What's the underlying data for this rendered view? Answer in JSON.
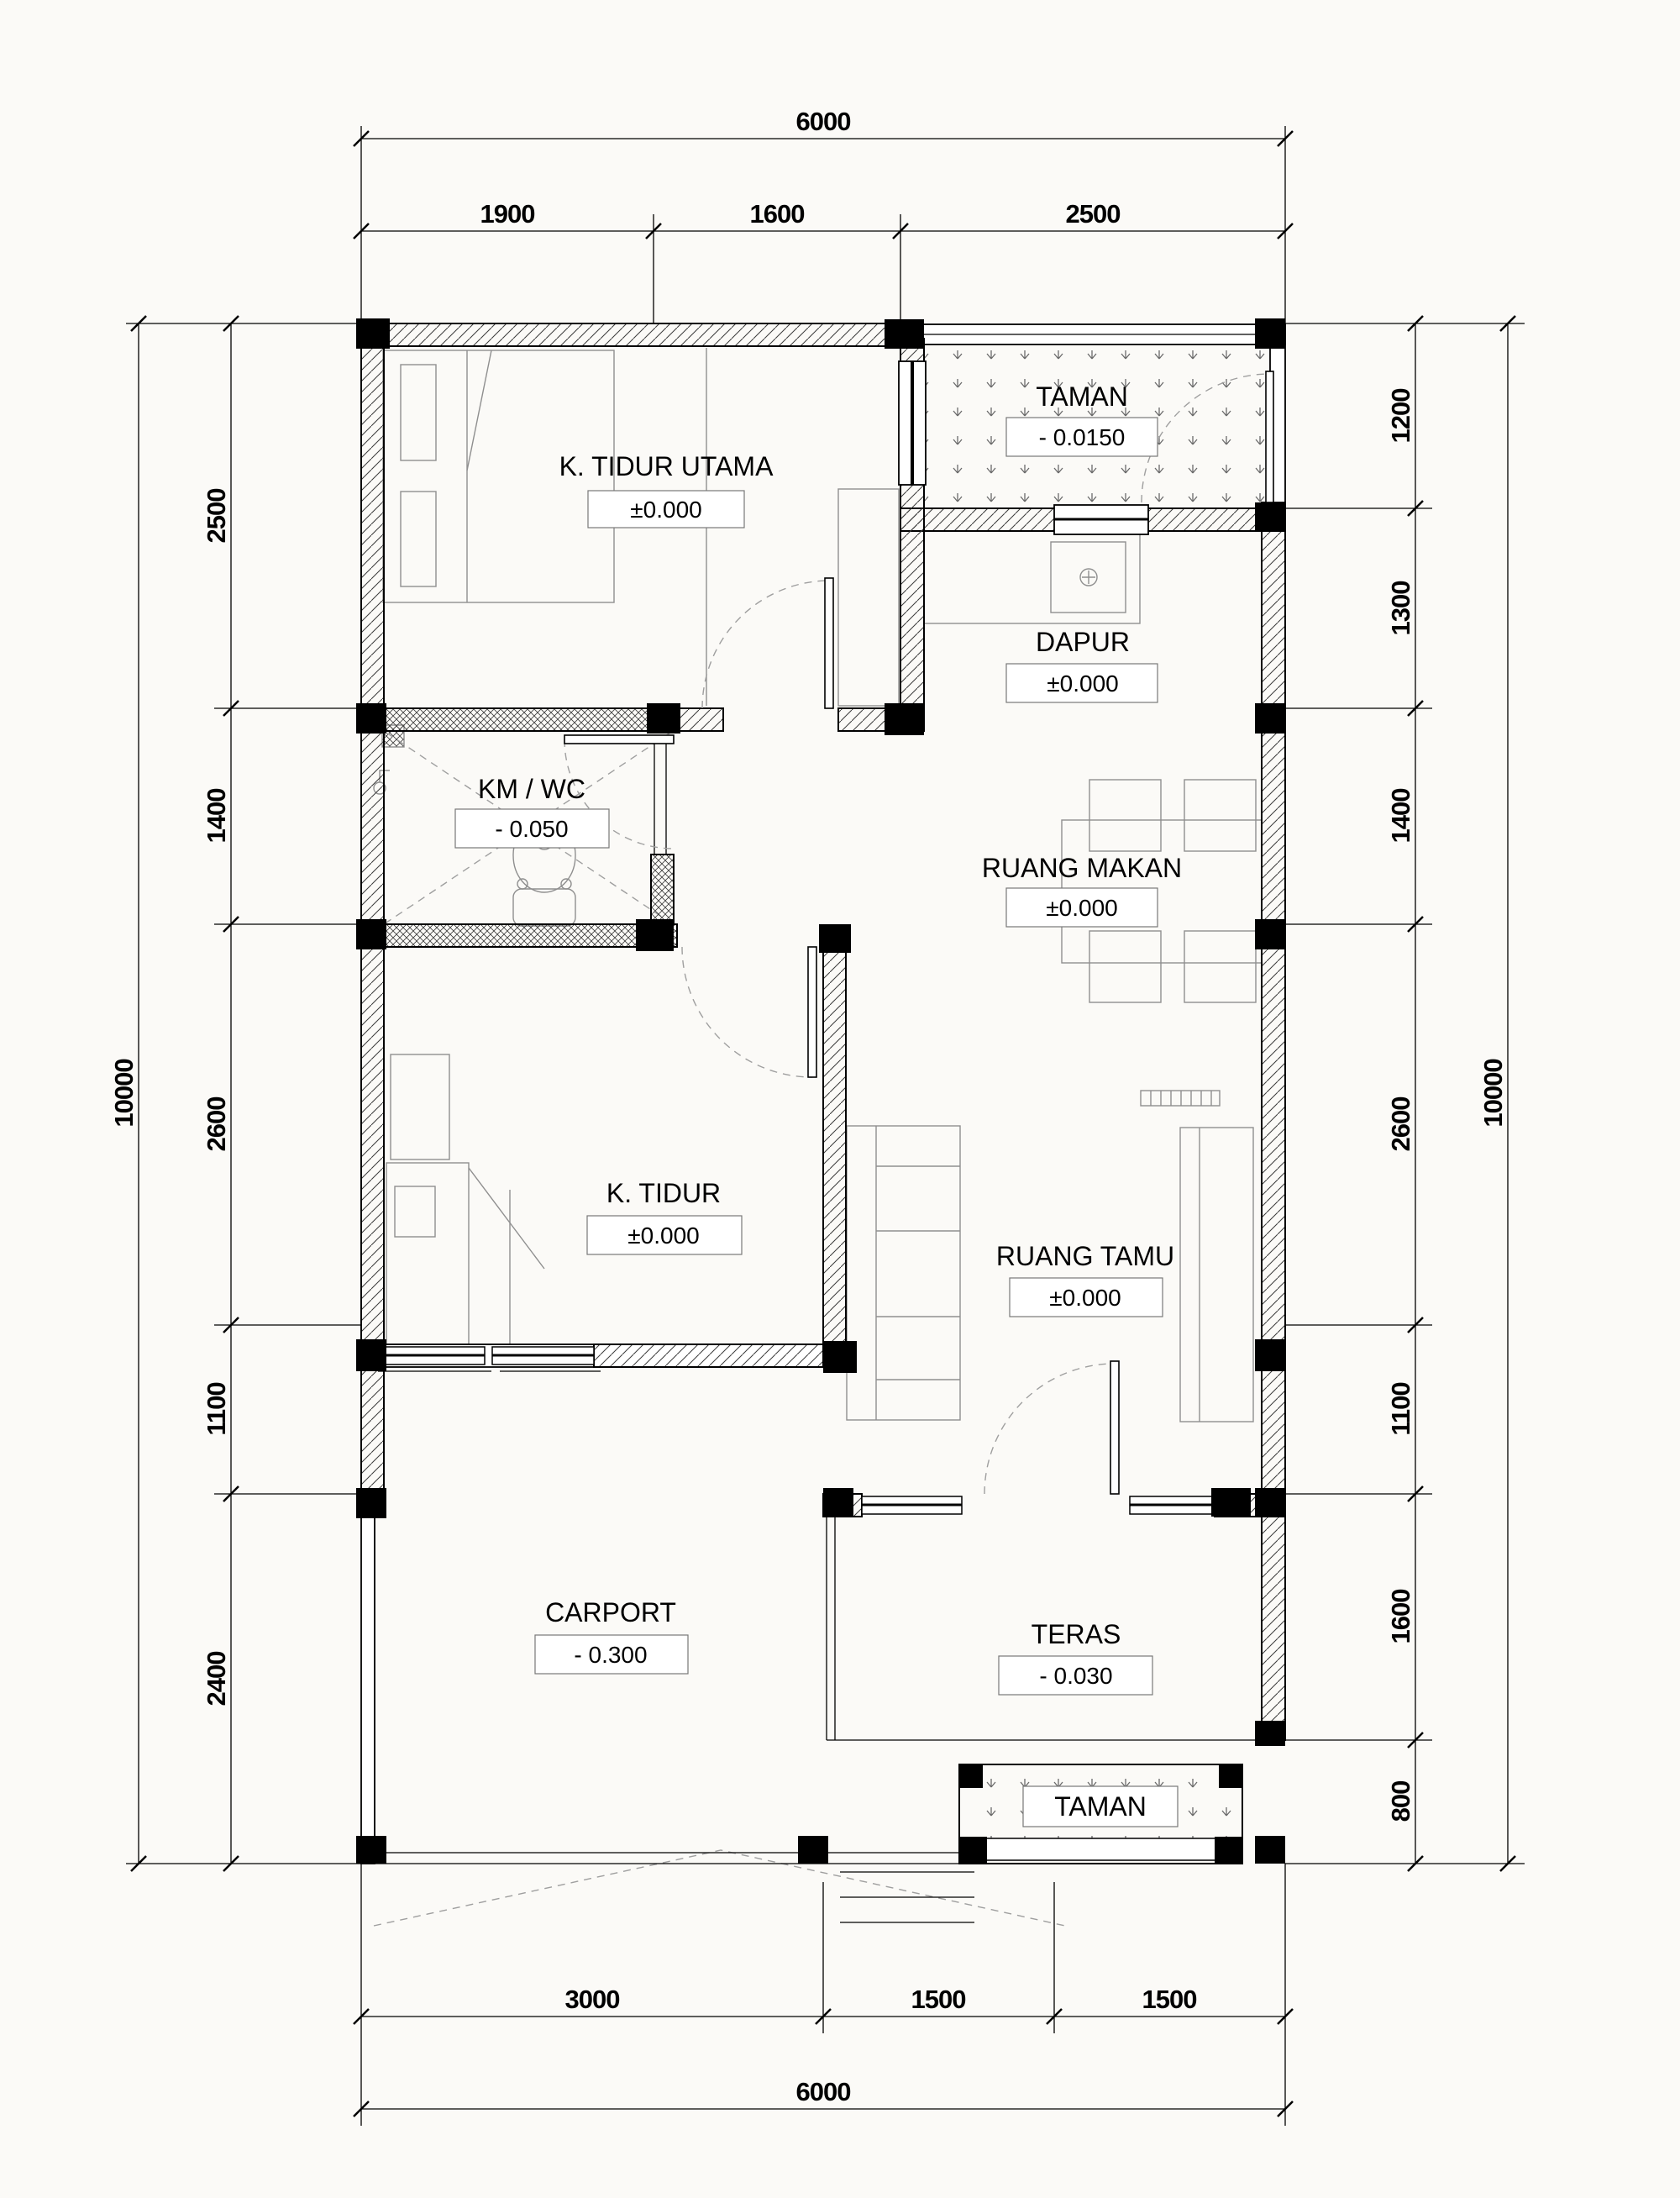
{
  "rooms": {
    "k_tidur_utama": {
      "name": "K. TIDUR UTAMA",
      "level": "±0.000"
    },
    "taman_top": {
      "name": "TAMAN",
      "level": "- 0.0150"
    },
    "dapur": {
      "name": "DAPUR",
      "level": "±0.000"
    },
    "km_wc": {
      "name": "KM / WC",
      "level": "- 0.050"
    },
    "ruang_makan": {
      "name": "RUANG MAKAN",
      "level": "±0.000"
    },
    "k_tidur": {
      "name": "K. TIDUR",
      "level": "±0.000"
    },
    "ruang_tamu": {
      "name": "RUANG TAMU",
      "level": "±0.000"
    },
    "carport": {
      "name": "CARPORT",
      "level": "- 0.300"
    },
    "teras": {
      "name": "TERAS",
      "level": "- 0.030"
    },
    "taman_bottom": {
      "name": "TAMAN"
    }
  },
  "dimensions": {
    "top_total": "6000",
    "top_segments": [
      "1900",
      "1600",
      "2500"
    ],
    "left_total": "10000",
    "left_segments": [
      "2500",
      "1400",
      "2600",
      "1100",
      "2400"
    ],
    "right_total": "10000",
    "right_segments": [
      "1200",
      "1300",
      "1400",
      "2600",
      "1100",
      "1600",
      "800"
    ],
    "bottom_total": "6000",
    "bottom_segments": [
      "3000",
      "1500",
      "1500"
    ]
  },
  "colors": {
    "paper": "#fbfaf7",
    "ink": "#000000",
    "furniture": "#8f8f8f"
  }
}
